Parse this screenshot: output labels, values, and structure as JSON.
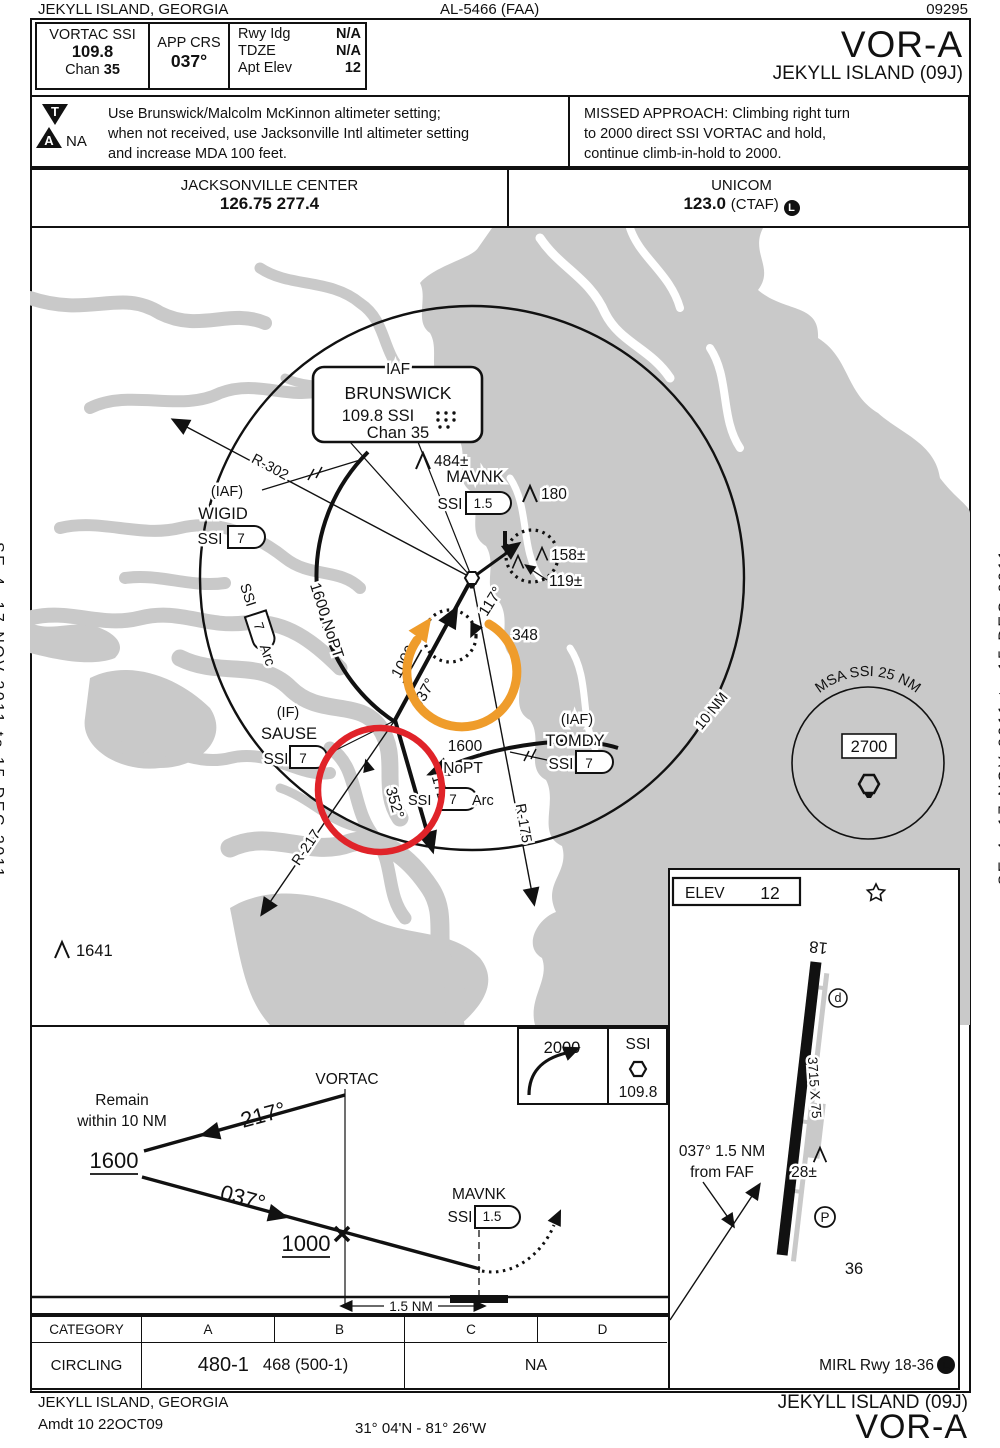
{
  "colors": {
    "map_gray": "#c9c9c9",
    "annotation_orange": "#ef9c2b",
    "annotation_red": "#e02329"
  },
  "margins": {
    "left": "SE-4, 17 NOV 2011 to 15 DEC 2011",
    "right": "SE-4, 17 NOV 2011 to 15 DEC 2011"
  },
  "top_bar": {
    "city": "JEKYLL ISLAND, GEORGIA",
    "chart_ref": "AL-5466 (FAA)",
    "chart_number": "09295"
  },
  "briefing": {
    "navaid": "VORTAC  SSI",
    "freq": "109.8",
    "chan_label": "Chan",
    "chan_value": "35",
    "app_crs_label": "APP CRS",
    "app_crs_value": "037°",
    "rwy_ldg_label": "Rwy Idg",
    "rwy_ldg_value": "N/A",
    "tdze_label": "TDZE",
    "tdze_value": "N/A",
    "apt_elev_label": "Apt Elev",
    "apt_elev_value": "12",
    "procedure": "VOR-A",
    "airport": "JEKYLL ISLAND  (09J)"
  },
  "notes": {
    "ta_t": "T",
    "ta_a": "A",
    "ta_na": "NA",
    "altimeter": "Use Brunswick/Malcolm McKinnon altimeter setting;\nwhen not received, use Jacksonville Intl altimeter setting\nand increase MDA 100 feet.",
    "missed": "MISSED APPROACH:  Climbing right turn\nto 2000 direct SSI VORTAC and hold,\ncontinue climb-in-hold to 2000."
  },
  "comms": {
    "center_name": "JACKSONVILLE CENTER",
    "center_freqs": "126.75  277.4",
    "unicom_name": "UNICOM",
    "unicom_freq": "123.0",
    "unicom_ctaf": "(CTAF)",
    "ctaf_badge": "L"
  },
  "plan": {
    "iaf_title": "IAF",
    "iaf_name": "BRUNSWICK",
    "iaf_freq": "109.8  SSI",
    "iaf_chan": "Chan 35",
    "r302": "R-302",
    "wigid_iaf": "(IAF)",
    "wigid_name": "WIGID",
    "wigid_ssi": "SSI",
    "wigid_dme": "7",
    "arc_left_alt": "1600 NoPT",
    "arc_left_ssi": "SSI",
    "arc_left_dme": "7",
    "arc_left_arc": "Arc",
    "obst_484": "484±",
    "mavnk_name": "MAVNK",
    "mavnk_ssi": "SSI",
    "mavnk_dme": "1.5",
    "obst_180": "180",
    "obst_158": "158±",
    "obst_119": "119±",
    "crs_117": "117°",
    "rad_348": "348",
    "final_alt": "1000",
    "final_crs": "037°",
    "sause_if": "(IF)",
    "sause_name": "SAUSE",
    "sause_ssi": "SSI",
    "sause_dme": "7",
    "crs_172": "172°",
    "crs_352": "352°",
    "r217": "R-217",
    "arc_right_alt1": "1600",
    "arc_right_alt2": "NoPT",
    "arc_right_ssi": "SSI",
    "arc_right_dme": "7",
    "arc_right_arc": "Arc",
    "r175": "R-175",
    "tomdy_iaf": "(IAF)",
    "tomdy_name": "TOMDY",
    "tomdy_ssi": "SSI",
    "tomdy_dme": "7",
    "ring_label": "10 NM",
    "obst_1641": "1641",
    "msa_label": "MSA SSI 25 NM",
    "msa_alt": "2700"
  },
  "profile": {
    "remain1": "Remain",
    "remain2": "within 10 NM",
    "vortac": "VORTAC",
    "crs_217": "217°",
    "alt_1600": "1600",
    "crs_037": "037°",
    "alt_1000": "1000",
    "mavnk_name": "MAVNK",
    "mavnk_ssi": "SSI",
    "mavnk_dme": "1.5",
    "missed_alt": "2000",
    "missed_navaid": "SSI",
    "missed_freq": "109.8",
    "dist": "1.5 NM"
  },
  "sketch": {
    "elev_label": "ELEV",
    "elev_value": "12",
    "rwy_18": "18",
    "rwy_36": "36",
    "rwy_dims": "3715 X 75",
    "obst_28": "28±",
    "ramp_d": "d",
    "parking_p": "P",
    "faf_line1": "037° 1.5 NM",
    "faf_line2": "from FAF",
    "lights": "MIRL Rwy 18-36",
    "lights_badge": "L"
  },
  "minimums": {
    "header": [
      "CATEGORY",
      "A",
      "B",
      "C",
      "D"
    ],
    "row_label": "CIRCLING",
    "a_b_main": "480-1",
    "a_b_detail": "468 (500-1)",
    "c_d": "NA"
  },
  "footer": {
    "city": "JEKYLL ISLAND, GEORGIA",
    "amdt": "Amdt 10  22OCT09",
    "coords": "31° 04'N - 81° 26'W",
    "airport": "JEKYLL ISLAND  (09J)",
    "procedure": "VOR-A"
  }
}
